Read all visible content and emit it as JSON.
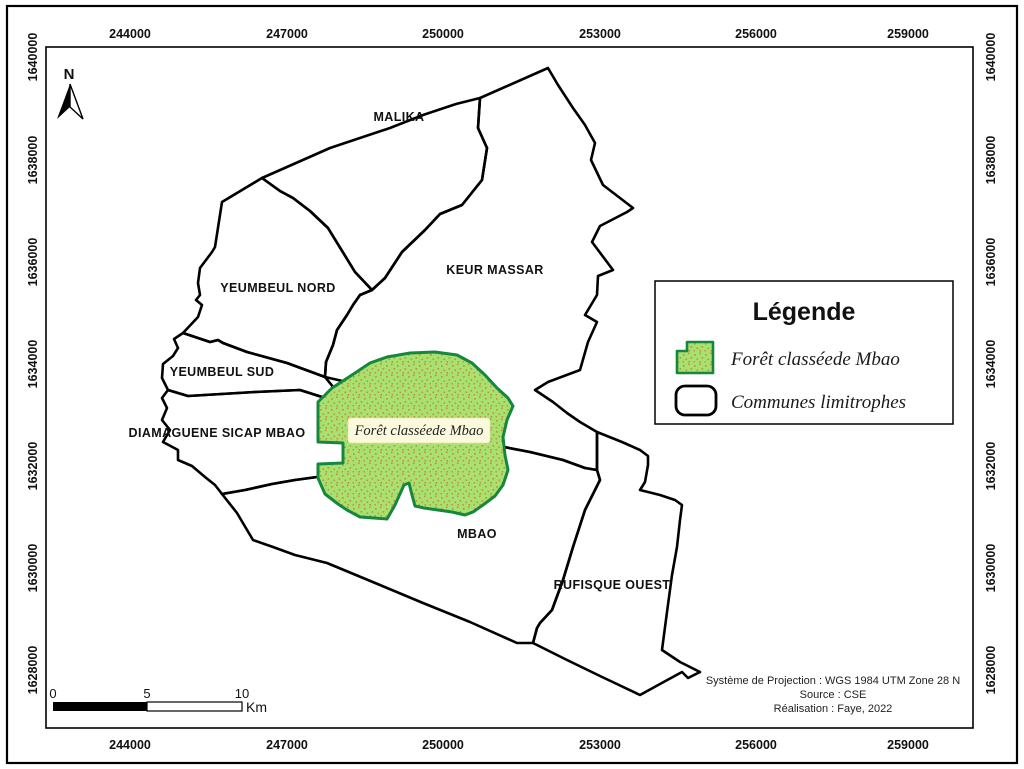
{
  "map": {
    "north_label": "N",
    "communes": [
      {
        "name": "MALIKA"
      },
      {
        "name": "KEUR MASSAR"
      },
      {
        "name": "YEUMBEUL NORD"
      },
      {
        "name": "YEUMBEUL SUD"
      },
      {
        "name": "DIAMAGUENE SICAP MBAO"
      },
      {
        "name": "MBAO"
      },
      {
        "name": "RUFISQUE OUEST"
      }
    ],
    "forest_label": "Forêt classéede Mbao"
  },
  "axes": {
    "x_ticks": [
      "244000",
      "247000",
      "250000",
      "253000",
      "256000",
      "259000"
    ],
    "y_ticks": [
      "1640000",
      "1638000",
      "1636000",
      "1634000",
      "1632000",
      "1630000",
      "1628000"
    ]
  },
  "legend": {
    "title": "Légende",
    "items": [
      {
        "label": "Forêt classéede Mbao"
      },
      {
        "label": "Communes limitrophes"
      }
    ]
  },
  "scalebar": {
    "tick0": "0",
    "tick5": "5",
    "tick10": "10",
    "unit": "Km"
  },
  "credits": {
    "line1": "Système de Projection : WGS 1984 UTM Zone 28 N",
    "line2": "Source : CSE",
    "line3": "Réalisation : Faye, 2022"
  },
  "colors": {
    "forest_fill": "#a9e170",
    "forest_stroke": "#15873f",
    "forest_dots": "#b59b3e",
    "forest_label_box": "#fcfadc",
    "outline": "#000000"
  }
}
